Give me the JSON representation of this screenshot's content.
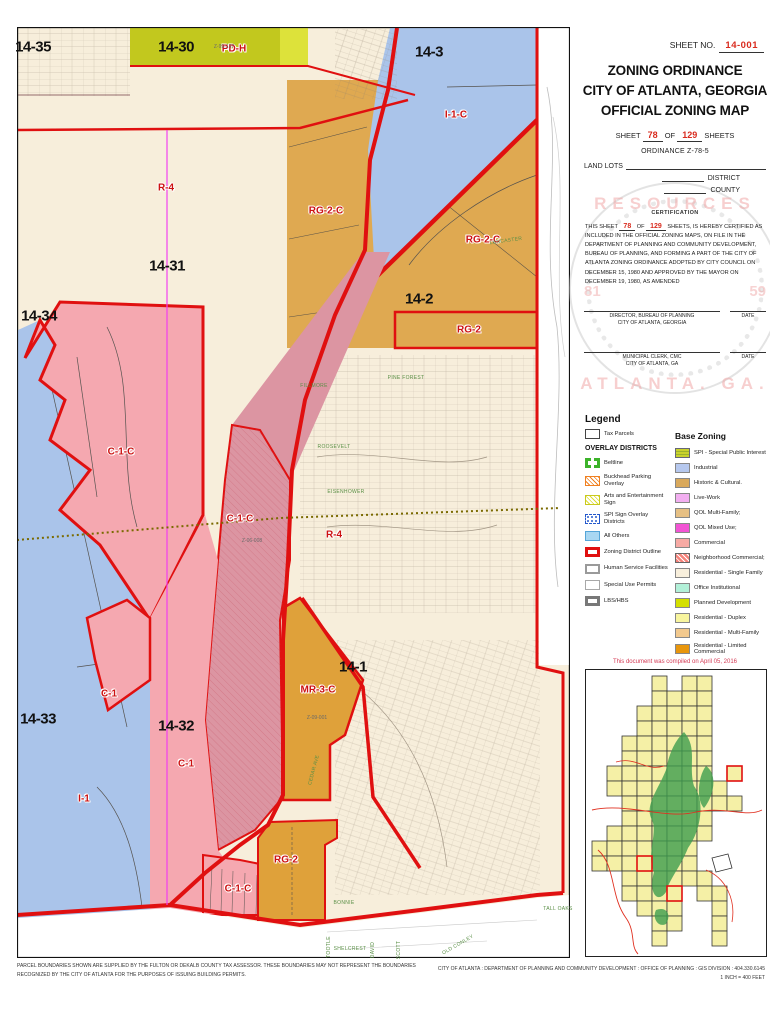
{
  "title_block": {
    "sheet_no_label": "SHEET NO.",
    "sheet_no_value": "14-001",
    "title_line1": "ZONING ORDINANCE",
    "title_line2": "CITY OF ATLANTA, GEORGIA",
    "title_line3": "OFFICIAL ZONING MAP",
    "sheet_prefix": "SHEET",
    "sheet_value": "78",
    "sheet_mid": "OF",
    "sheet_total": "129",
    "sheet_suffix": "SHEETS",
    "ordinance": "ORDINANCE Z-78-5",
    "land_lots_label": "LAND LOTS",
    "district_label": "DISTRICT",
    "county_label": "COUNTY"
  },
  "certification": {
    "heading": "CERTIFICATION",
    "p1": "THIS SHEET",
    "sheet_value": "78",
    "p2": "OF",
    "sheet_total": "129",
    "p3": "SHEETS, IS HEREBY CERTIFIED AS INCLUDED IN THE OFFICIAL ZONING MAPS, ON FILE IN THE DEPARTMENT OF PLANNING AND COMMUNITY DEVELOPMENT, BUREAU OF PLANNING, AND FORMING A PART OF THE CITY OF ATLANTA ZONING ORDINANCE ADOPTED BY CITY COUNCIL ON DECEMBER 15, 1980 AND APPROVED BY THE MAYOR ON DECEMBER 19, 1980, AS AMENDED"
  },
  "signatures": [
    {
      "line1": "DIRECTOR, BUREAU OF PLANNING",
      "line2": "CITY OF ATLANTA, GEORGIA",
      "date_label": "DATE"
    },
    {
      "line1": "MUNICIPAL CLERK, CMC",
      "line2": "CITY OF ATLANTA, GA",
      "date_label": "DATE"
    }
  ],
  "watermark": {
    "arc_top": "RESOURCES",
    "arc_bottom": "ATLANTA. GA.",
    "left": "81",
    "right": "59"
  },
  "legend": {
    "heading": "Legend",
    "tax_parcels_label": "Tax Parcels",
    "overlay_heading": "OVERLAY DISTRICTS",
    "overlay_items": [
      {
        "label": "Beltline",
        "swatch": "beltline"
      },
      {
        "label": "Buckhead Parking Overlay",
        "swatch": "buckhead"
      },
      {
        "label": "Arts and Entertainment Sign",
        "swatch": "arts"
      },
      {
        "label": "SPI Sign Overlay Districts",
        "swatch": "spi-sign"
      },
      {
        "label": "All Others",
        "swatch": "all-others"
      },
      {
        "label": "Zoning District Outline",
        "swatch": "zoning-outline"
      },
      {
        "label": "Human Service Facilities",
        "swatch": "human-service"
      },
      {
        "label": "Special Use Permits",
        "swatch": "special-use"
      },
      {
        "label": "LBS/HBS",
        "swatch": "lbs-hbs"
      }
    ],
    "base_heading": "Base Zoning",
    "base_items": [
      {
        "label": "SPI - Special Public Interest",
        "swatch": "spi",
        "color": "#c9d22c"
      },
      {
        "label": "Industrial",
        "color": "#b6c8ee"
      },
      {
        "label": "Historic & Cultural.",
        "color": "#d9a95c"
      },
      {
        "label": "Live-Work",
        "color": "#f2aef0"
      },
      {
        "label": "QOL Multi-Family;",
        "color": "#e6c084"
      },
      {
        "label": "QOL Mixed Use;",
        "color": "#f254d4"
      },
      {
        "label": "Commercial",
        "color": "#f7aaa4"
      },
      {
        "label": "Neighborhood Commercial;",
        "swatch": "nc",
        "color": "#f5837b"
      },
      {
        "label": "Residential - Single Family",
        "color": "#f8efdc"
      },
      {
        "label": "Office Institutional",
        "color": "#b2f0d8"
      },
      {
        "label": "Planned Development",
        "color": "#d4e000"
      },
      {
        "label": "Residential - Duplex",
        "color": "#f8f59e"
      },
      {
        "label": "Residential - Multi-Family",
        "color": "#f2c98e"
      },
      {
        "label": "Residential - Limited Commercial",
        "color": "#e8960c"
      }
    ]
  },
  "compiled_note": "This document was compiled on April 05, 2016",
  "footer": {
    "left_text": "PARCEL BOUNDARIES SHOWN ARE SUPPLIED BY THE FULTON OR DEKALB COUNTY TAX ASSESSOR.  THESE BOUNDARIES MAY NOT REPRESENT THE BOUNDARIES RECOGNIZED BY THE CITY OF ATLANTA FOR THE PURPOSES OF ISSUING BUILDING PERMITS.",
    "right_line1": "CITY OF ATLANTA : DEPARTMENT OF PLANNING AND COMMUNITY DEVELOPMENT : OFFICE OF PLANNING : GIS DIVISION : 404.330.6145",
    "right_line2": "1 INCH = 400 FEET"
  },
  "map": {
    "colors": {
      "residential_single_family": "#f7eedb",
      "industrial_blue": "#aac4ea",
      "multi_family_tan": "#dfa951",
      "planned_dev_olive": "#c2c81e",
      "planned_dev_bright": "#dde23a",
      "commercial_pink": "#f5a8b0",
      "commercial_corridor_pink": "#dc95a2",
      "limited_commercial_orange": "#dfa13a",
      "district_outline_red": "#e01010",
      "overlay_magenta": "#f23cf2",
      "city_limit_olive": "#7a6a00"
    },
    "labels": [
      {
        "text": "14-35",
        "x": 33,
        "y": 47,
        "cls": "district"
      },
      {
        "text": "14-30",
        "x": 176,
        "y": 47,
        "cls": "district"
      },
      {
        "text": "14-3",
        "x": 429,
        "y": 52,
        "cls": "district"
      },
      {
        "text": "14-31",
        "x": 167,
        "y": 266,
        "cls": "district"
      },
      {
        "text": "14-2",
        "x": 419,
        "y": 299,
        "cls": "district"
      },
      {
        "text": "14-34",
        "x": 39,
        "y": 316,
        "cls": "district"
      },
      {
        "text": "14-33",
        "x": 38,
        "y": 719,
        "cls": "district"
      },
      {
        "text": "14-32",
        "x": 176,
        "y": 726,
        "cls": "district"
      },
      {
        "text": "14-1",
        "x": 353,
        "y": 667,
        "cls": "district"
      },
      {
        "text": "PD-H",
        "x": 234,
        "y": 49,
        "cls": "zone"
      },
      {
        "text": "I-1-C",
        "x": 456,
        "y": 115,
        "cls": "zone"
      },
      {
        "text": "R-4",
        "x": 166,
        "y": 188,
        "cls": "zone"
      },
      {
        "text": "RG-2-C",
        "x": 326,
        "y": 211,
        "cls": "zone"
      },
      {
        "text": "RG-2-C",
        "x": 483,
        "y": 240,
        "cls": "zone"
      },
      {
        "text": "RG-2",
        "x": 469,
        "y": 330,
        "cls": "zone"
      },
      {
        "text": "C-1-C",
        "x": 121,
        "y": 452,
        "cls": "zone"
      },
      {
        "text": "C-1-C",
        "x": 240,
        "y": 519,
        "cls": "zone"
      },
      {
        "text": "R-4",
        "x": 334,
        "y": 535,
        "cls": "zone"
      },
      {
        "text": "MR-3-C",
        "x": 318,
        "y": 690,
        "cls": "zone"
      },
      {
        "text": "C-1",
        "x": 109,
        "y": 694,
        "cls": "zone"
      },
      {
        "text": "C-1",
        "x": 186,
        "y": 764,
        "cls": "zone"
      },
      {
        "text": "I-1",
        "x": 84,
        "y": 799,
        "cls": "zone"
      },
      {
        "text": "RG-2",
        "x": 286,
        "y": 860,
        "cls": "zone"
      },
      {
        "text": "C-1-C",
        "x": 238,
        "y": 889,
        "cls": "zone"
      },
      {
        "text": "Z-99-137",
        "x": 224,
        "y": 47,
        "cls": "case"
      },
      {
        "text": "Z-06-008",
        "x": 252,
        "y": 541,
        "cls": "case"
      },
      {
        "text": "Z-09-001",
        "x": 317,
        "y": 718,
        "cls": "case"
      },
      {
        "text": "FILLMORE",
        "x": 314,
        "y": 386,
        "cls": "street"
      },
      {
        "text": "ROOSEVELT",
        "x": 334,
        "y": 447,
        "cls": "street"
      },
      {
        "text": "EISENHOWER",
        "x": 346,
        "y": 492,
        "cls": "street"
      },
      {
        "text": "LANCASTER",
        "x": 506,
        "y": 241,
        "cls": "street",
        "rot": -8
      },
      {
        "text": "PINE FOREST",
        "x": 406,
        "y": 378,
        "cls": "street"
      },
      {
        "text": "CEDAR AVE",
        "x": 314,
        "y": 770,
        "cls": "street",
        "rot": -75
      },
      {
        "text": "BONNIE",
        "x": 344,
        "y": 903,
        "cls": "street"
      },
      {
        "text": "TALL OAKS",
        "x": 558,
        "y": 909,
        "cls": "street"
      },
      {
        "text": "OLD CONLEY",
        "x": 458,
        "y": 945,
        "cls": "street",
        "rot": -30
      },
      {
        "text": "SHELCREST",
        "x": 350,
        "y": 949,
        "cls": "street"
      },
      {
        "text": "TOOTLE",
        "x": 329,
        "y": 947,
        "cls": "street",
        "rot": -90
      },
      {
        "text": "DAVID",
        "x": 373,
        "y": 950,
        "cls": "street",
        "rot": -90
      },
      {
        "text": "SCOTT",
        "x": 399,
        "y": 950,
        "cls": "street",
        "rot": -90
      },
      {
        "text": "MILL OAKS",
        "x": 746,
        "y": 905,
        "cls": "street"
      }
    ]
  }
}
